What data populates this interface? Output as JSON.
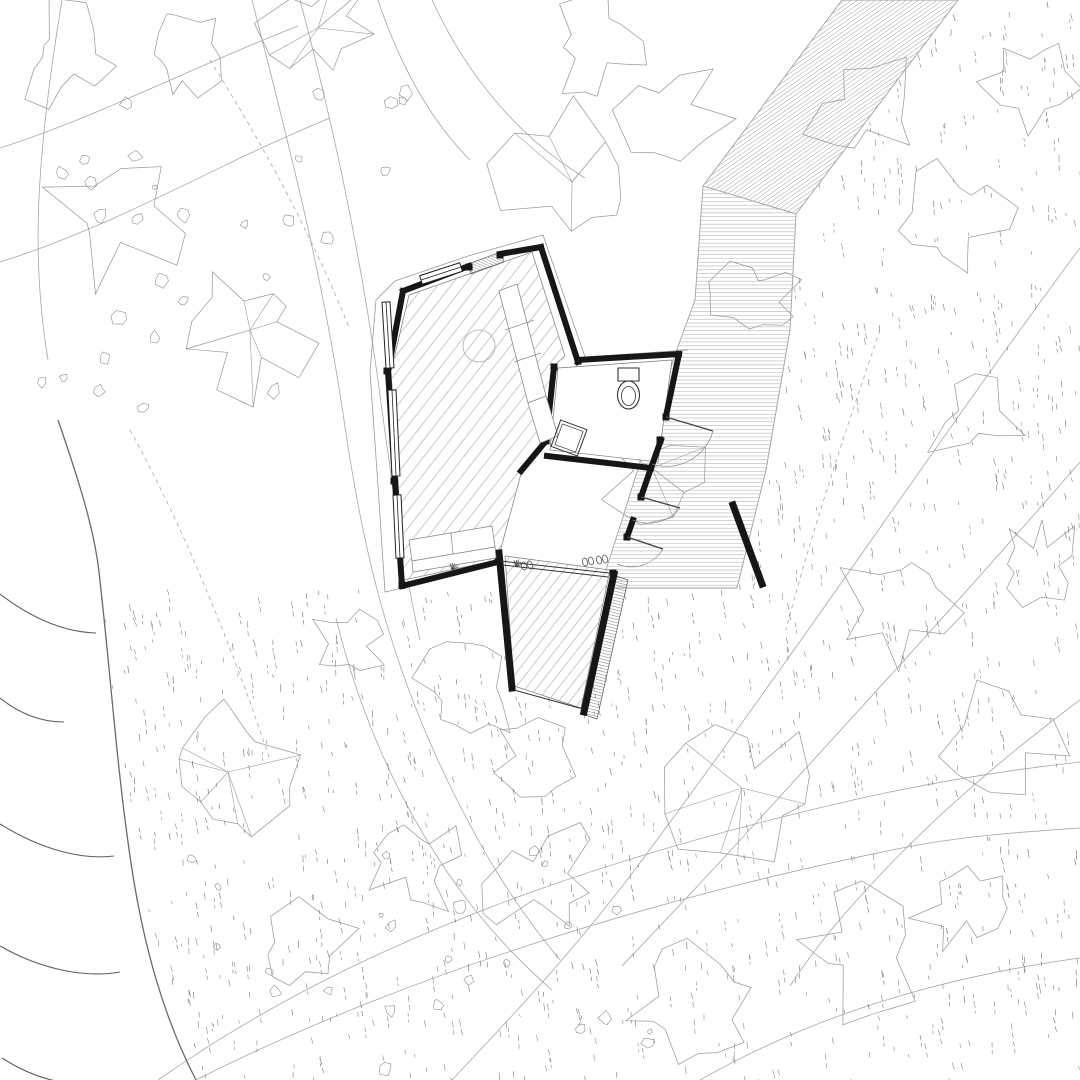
{
  "meta": {
    "title": "Cabin site plan drawing",
    "type": "architectural-site-plan"
  },
  "canvas": {
    "w": 1080,
    "h": 1080,
    "bg": "#ffffff"
  },
  "colors": {
    "wall": "#161616",
    "shoreline": "#6a6a6a",
    "wave": "#5f5f5f",
    "contour": "#a6a6a6",
    "canopy": "#9b9b9b",
    "stone": "#8e8e8e",
    "dash": "#6e6e6e",
    "floor_hatch": "#b4b4b4",
    "band_hatch": "#b0b0b0",
    "terrace_hatch": "#b6b6b6",
    "steps_hatch": "#8f8f8f",
    "furniture": "#8a8a8a",
    "fixture": "#333333",
    "roofline": "#999999",
    "outline": "#9e9e9e"
  },
  "contours": {
    "solid": [
      "M 252,0 C 285,130 322,270 344,420 C 362,545 388,660 452,790 C 480,846 510,900 560,960",
      "M 300,0 C 332,120 358,240 378,380 C 390,470 402,560 420,640",
      "M 0,148 C 95,118 195,66 298,26",
      "M 0,262 C 78,238 158,198 240,158 C 270,144 300,130 330,118",
      "M 432,0 C 468,78 520,138 585,178",
      "M 378,0 C 398,60 428,118 470,160",
      "M 1080,248 C 952,420 808,636 648,852 C 576,950 512,1016 452,1080",
      "M 1080,462 C 962,598 852,718 742,838 C 700,884 660,926 622,966",
      "M 196,1080 C 398,978 652,898 902,848 C 962,836 1022,832 1080,828",
      "M 158,1080 C 360,938 606,856 862,798 C 934,782 1008,770 1080,762",
      "M 700,1080 C 802,1022 922,980 1080,958",
      "M 336,618 C 356,700 388,780 438,858 C 470,908 508,952 552,990",
      "M 1080,700 C 1002,758 930,820 868,888 C 838,920 812,952 790,986",
      "M 62,0 C 52,60 44,120 40,180 C 36,240 38,300 48,360"
    ],
    "dashed": [
      "M 210,60 C 260,140 310,230 350,330",
      "M 880,330 C 846,430 812,530 786,630",
      "M 130,430 C 180,520 230,640 270,760"
    ]
  },
  "water": {
    "shoreline": "M 58,420 C 78,478 94,528 99,572 C 110,668 116,756 128,842 C 142,948 166,1022 196,1080",
    "waves": [
      "M 0,594 C 34,620 66,632 96,633",
      "M 0,698 C 20,714 42,722 64,722",
      "M 0,824 C 42,850 82,860 114,856",
      "M 0,946 C 42,970 86,978 120,972",
      "M 2,1058 C 30,1076 58,1084 84,1084"
    ]
  },
  "band": {
    "poly": [
      [
        842,
        0
      ],
      [
        958,
        0
      ],
      [
        796,
        214
      ],
      [
        703,
        186
      ]
    ],
    "hatch_angle": -35,
    "hatch_spacing": 3.5
  },
  "terrace": {
    "poly": [
      [
        703,
        186
      ],
      [
        796,
        214
      ],
      [
        790,
        330
      ],
      [
        766,
        470
      ],
      [
        737,
        588
      ],
      [
        600,
        588
      ],
      [
        622,
        520
      ],
      [
        650,
        430
      ],
      [
        676,
        352
      ],
      [
        695,
        300
      ]
    ],
    "hatch_angle": 0,
    "hatch_spacing": 3.8
  },
  "trees": [
    [
      318,
      28,
      65,
      1
    ],
    [
      118,
      215,
      80,
      0
    ],
    [
      250,
      330,
      70,
      1
    ],
    [
      572,
      182,
      82,
      1
    ],
    [
      598,
      48,
      52,
      0
    ],
    [
      675,
      112,
      55,
      0
    ],
    [
      862,
      112,
      65,
      0
    ],
    [
      952,
      222,
      60,
      0
    ],
    [
      1032,
      82,
      50,
      0
    ],
    [
      758,
      296,
      48,
      0
    ],
    [
      652,
      468,
      52,
      1
    ],
    [
      468,
      692,
      58,
      0
    ],
    [
      228,
      772,
      72,
      1
    ],
    [
      742,
      788,
      78,
      1
    ],
    [
      902,
      602,
      62,
      0
    ],
    [
      1002,
      732,
      65,
      0
    ],
    [
      542,
      878,
      66,
      0
    ],
    [
      858,
      948,
      72,
      0
    ],
    [
      298,
      952,
      58,
      0
    ],
    [
      688,
      1008,
      62,
      0
    ],
    [
      418,
      866,
      52,
      0
    ],
    [
      975,
      418,
      52,
      0
    ],
    [
      62,
      58,
      55,
      0
    ],
    [
      182,
      55,
      45,
      0
    ],
    [
      965,
      905,
      55,
      0
    ],
    [
      1040,
      560,
      45,
      0
    ],
    [
      352,
      642,
      40,
      0
    ],
    [
      530,
      760,
      45,
      0
    ]
  ],
  "stone_clusters": [
    {
      "x": 165,
      "y": 300,
      "n": 16,
      "s": 130
    },
    {
      "x": 340,
      "y": 150,
      "n": 7,
      "s": 90
    },
    {
      "x": 120,
      "y": 150,
      "n": 6,
      "s": 70
    },
    {
      "x": 500,
      "y": 955,
      "n": 12,
      "s": 120
    },
    {
      "x": 255,
      "y": 935,
      "n": 6,
      "s": 80
    },
    {
      "x": 430,
      "y": 1035,
      "n": 6,
      "s": 80
    },
    {
      "x": 615,
      "y": 1060,
      "n": 5,
      "s": 70
    }
  ],
  "dashes": {
    "count": 1300,
    "seed": 7
  },
  "dash_exclusions": [
    [
      [
        0,
        430
      ],
      [
        100,
        575
      ],
      [
        128,
        840
      ],
      [
        196,
        1080
      ],
      [
        0,
        1080
      ]
    ],
    [
      [
        842,
        0
      ],
      [
        958,
        0
      ],
      [
        796,
        214
      ],
      [
        703,
        186
      ]
    ],
    [
      [
        703,
        186
      ],
      [
        796,
        214
      ],
      [
        790,
        330
      ],
      [
        766,
        470
      ],
      [
        737,
        588
      ],
      [
        600,
        588
      ],
      [
        622,
        520
      ],
      [
        650,
        430
      ],
      [
        676,
        352
      ],
      [
        695,
        300
      ]
    ]
  ],
  "building": {
    "floors": {
      "main": {
        "poly": [
          [
            409,
            295
          ],
          [
            532,
            252
          ],
          [
            565,
            356
          ],
          [
            556,
            364
          ],
          [
            547,
            440
          ],
          [
            522,
            470
          ],
          [
            500,
            552
          ],
          [
            497,
            560
          ],
          [
            404,
            580
          ],
          [
            398,
            480
          ],
          [
            391,
            371
          ]
        ],
        "hatch_angle": -52,
        "hatch_spacing": 10.5
      },
      "deck": {
        "poly": [
          [
            505,
            556
          ],
          [
            610,
            570
          ],
          [
            581,
            708
          ],
          [
            514,
            686
          ]
        ],
        "hatch_angle": -52,
        "hatch_spacing": 8.5
      },
      "bath": {
        "poly": [
          [
            558,
            368
          ],
          [
            672,
            360
          ],
          [
            658,
            462
          ],
          [
            550,
            450
          ]
        ]
      }
    },
    "roof_lines": [
      "M 376,300 L 395,281 L 468,256 L 543,235 L 585,357 L 688,350",
      "M 376,300 L 370,372 L 378,486 L 385,592 L 402,588"
    ],
    "walls": [
      {
        "pts": [
          [
            403,
            291
          ],
          [
            469,
            266
          ]
        ],
        "w": 6
      },
      {
        "pts": [
          [
            500,
            254
          ],
          [
            541,
            247
          ]
        ],
        "w": 6
      },
      {
        "pts": [
          [
            541,
            247
          ],
          [
            578,
            362
          ]
        ],
        "w": 6
      },
      {
        "pts": [
          [
            578,
            360
          ],
          [
            679,
            354
          ]
        ],
        "w": 6
      },
      {
        "pts": [
          [
            679,
            354
          ],
          [
            666,
            416
          ]
        ],
        "w": 6
      },
      {
        "pts": [
          [
            661,
            440
          ],
          [
            651,
            468
          ]
        ],
        "w": 6
      },
      {
        "pts": [
          [
            651,
            468
          ],
          [
            547,
            456
          ]
        ],
        "w": 6
      },
      {
        "pts": [
          [
            554,
            367
          ],
          [
            546,
            441
          ]
        ],
        "w": 6
      },
      {
        "pts": [
          [
            546,
            441
          ],
          [
            521,
            471
          ]
        ],
        "w": 6
      },
      {
        "pts": [
          [
            403,
            291
          ],
          [
            388,
            371
          ]
        ],
        "w": 6
      },
      {
        "pts": [
          [
            388,
            371
          ],
          [
            395,
            482
          ]
        ],
        "w": 6
      },
      {
        "pts": [
          [
            395,
            482
          ],
          [
            402,
            586
          ]
        ],
        "w": 6
      },
      {
        "pts": [
          [
            402,
            586
          ],
          [
            498,
            562
          ]
        ],
        "w": 6
      },
      {
        "pts": [
          [
            651,
            468
          ],
          [
            641,
            497
          ]
        ],
        "w": 6
      },
      {
        "pts": [
          [
            633,
            520
          ],
          [
            627,
            537
          ]
        ],
        "w": 6
      },
      {
        "pts": [
          [
            499,
            553
          ],
          [
            512,
            688
          ]
        ],
        "w": 7
      },
      {
        "pts": [
          [
            614,
            574
          ],
          [
            584,
            712
          ]
        ],
        "w": 7
      },
      {
        "pts": [
          [
            733,
            505
          ],
          [
            762,
            584
          ]
        ],
        "w": 7
      }
    ],
    "stubs": [
      [
        387,
        371
      ],
      [
        394,
        481
      ],
      [
        402,
        585
      ],
      [
        546,
        441
      ],
      [
        554,
        367
      ],
      [
        469,
        267
      ],
      [
        500,
        255
      ],
      [
        613,
        573
      ],
      [
        498,
        559
      ],
      [
        578,
        361
      ],
      [
        666,
        417
      ],
      [
        660,
        440
      ],
      [
        641,
        497
      ],
      [
        627,
        537
      ]
    ],
    "windows": [
      {
        "a": [
          421,
          280
        ],
        "b": [
          461,
          267
        ],
        "w": 9
      },
      {
        "a": [
          386,
          302
        ],
        "b": [
          390,
          368
        ],
        "w": 8
      },
      {
        "a": [
          392,
          390
        ],
        "b": [
          396,
          476
        ],
        "w": 8
      },
      {
        "a": [
          397,
          495
        ],
        "b": [
          400,
          558
        ],
        "w": 8
      }
    ],
    "threshold": {
      "poly": [
        [
          468,
          264
        ],
        [
          501,
          252
        ],
        [
          504,
          262
        ],
        [
          471,
          274
        ]
      ],
      "hatch_angle": 25,
      "hatch_spacing": 2.5
    },
    "steps": {
      "poly": [
        [
          616,
          576
        ],
        [
          628,
          580
        ],
        [
          597,
          719
        ],
        [
          585,
          715
        ]
      ],
      "hatch_angle": 14,
      "hatch_spacing": 3
    },
    "glazing": [
      [
        [
          500,
          561
        ],
        [
          609,
          573
        ]
      ],
      [
        [
          502,
          565
        ],
        [
          608,
          577
        ]
      ],
      [
        [
          514,
          690
        ],
        [
          583,
          709
        ]
      ]
    ],
    "doors": [
      {
        "leaf": [
          [
            666,
            417
          ],
          [
            713,
            431
          ]
        ],
        "arc": "M 713,431 A 48 48 0 0 1 652,464"
      },
      {
        "leaf": [
          [
            641,
            497
          ],
          [
            680,
            508
          ]
        ],
        "arc": "M 680,508 A 40 40 0 0 1 633,520"
      },
      {
        "leaf": [
          [
            627,
            537
          ],
          [
            663,
            549
          ]
        ],
        "arc": "M 663,549 A 37 37 0 0 1 617,564"
      }
    ],
    "furniture": {
      "table_circle": {
        "cx": 479,
        "cy": 346,
        "r": 16
      },
      "counter_quads": [
        [
          [
            499,
            291
          ],
          [
            517,
            284
          ],
          [
            546,
            396
          ],
          [
            528,
            403
          ]
        ],
        [
          [
            528,
            403
          ],
          [
            546,
            396
          ],
          [
            558,
            436
          ],
          [
            540,
            443
          ]
        ]
      ],
      "counter_dividers": [
        [
          [
            505,
            330
          ],
          [
            534,
            320
          ]
        ],
        [
          [
            514,
            362
          ],
          [
            541,
            353
          ]
        ]
      ],
      "bench_quads": [
        [
          [
            409,
            540
          ],
          [
            492,
            526
          ],
          [
            495,
            547
          ],
          [
            412,
            561
          ]
        ],
        [
          [
            412,
            561
          ],
          [
            495,
            547
          ],
          [
            496,
            558
          ],
          [
            413,
            572
          ]
        ]
      ],
      "bench_dividers": [
        [
          [
            451,
            533
          ],
          [
            453,
            554
          ]
        ]
      ],
      "toilet": {
        "tank": [
          [
            618,
            368
          ],
          [
            639,
            368
          ],
          [
            639,
            381
          ],
          [
            618,
            381
          ]
        ],
        "bowl": {
          "cx": 628.5,
          "cy": 395,
          "rx": 11,
          "ry": 14
        },
        "bowl_inner": {
          "cx": 628.5,
          "cy": 396,
          "rx": 7,
          "ry": 9.5
        }
      },
      "stool": {
        "cx": 569,
        "cy": 438,
        "half": 14,
        "rot": 20
      },
      "shoes": [
        [
          585,
          562
        ],
        [
          591,
          561
        ],
        [
          599,
          560
        ],
        [
          605,
          559
        ],
        [
          524,
          566
        ],
        [
          530,
          565
        ]
      ],
      "sprigs": [
        [
          452,
          570
        ],
        [
          516,
          567
        ]
      ]
    }
  }
}
